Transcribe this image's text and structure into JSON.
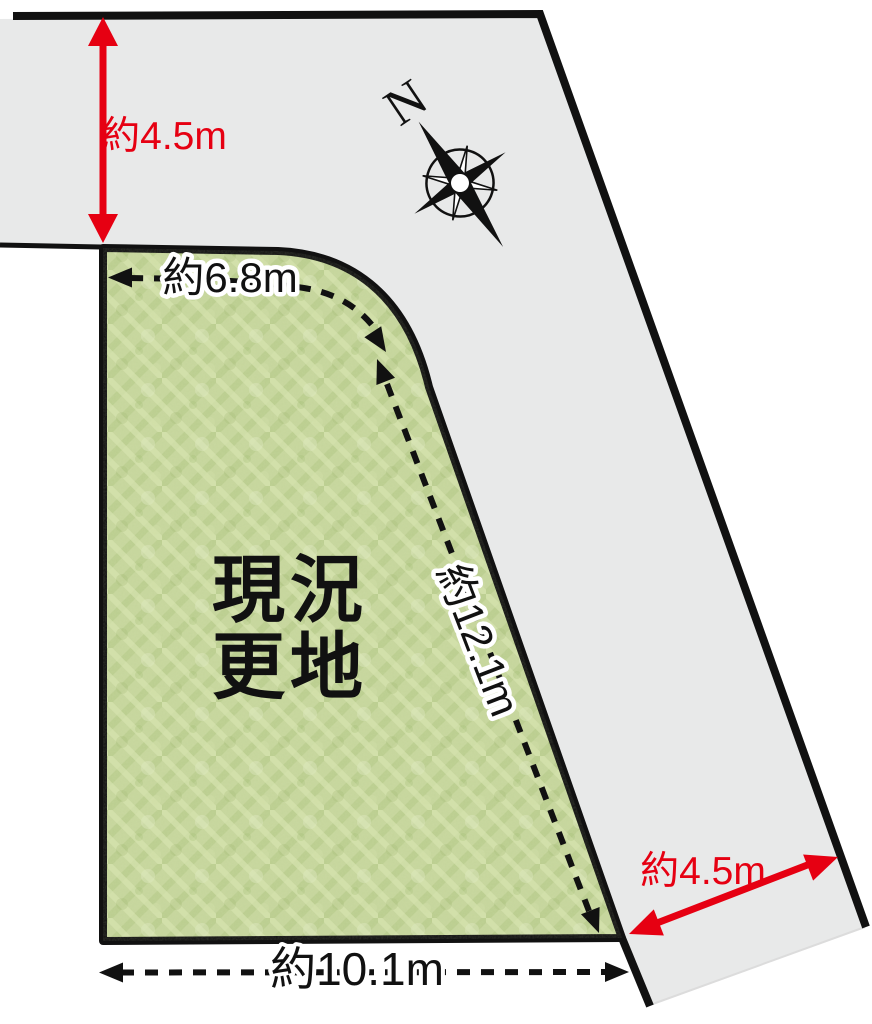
{
  "diagram": {
    "type": "land-plot-site-plan",
    "plot": {
      "status_line1": "現況",
      "status_line2": "更地"
    },
    "measurements": {
      "road_width_top": {
        "label": "約4.5m",
        "style": "solid-red-double-arrow",
        "measures": "road width (top road)"
      },
      "top_edge": {
        "label": "約6.8m",
        "style": "dashed-black-double-arrow",
        "measures": "plot top frontage"
      },
      "right_edge": {
        "label": "約12.1m",
        "style": "dashed-black-double-arrow",
        "measures": "plot right frontage"
      },
      "bottom_edge": {
        "label": "約10.1m",
        "style": "dashed-black-double-arrow",
        "measures": "plot bottom edge"
      },
      "road_width_right": {
        "label": "約4.5m",
        "style": "solid-red-double-arrow",
        "measures": "road width (right road)"
      }
    },
    "compass": {
      "north_label": "N"
    },
    "colors": {
      "road_gray": "#e8e9e9",
      "grass_green": "#c6d69c",
      "measure_red": "#e60012",
      "line_black": "#111111"
    }
  }
}
